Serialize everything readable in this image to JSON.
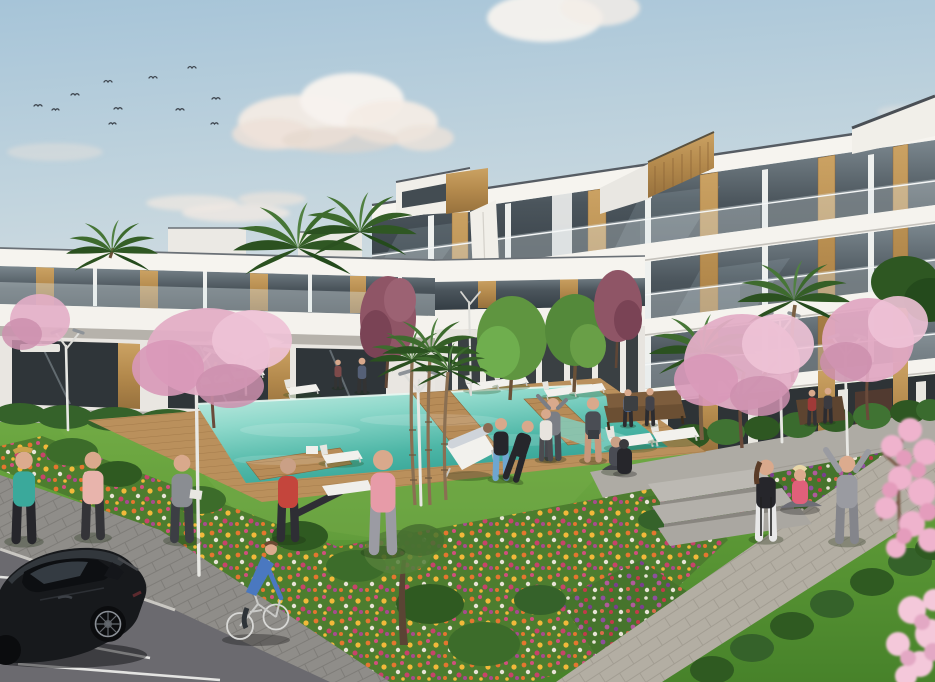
{
  "scene": {
    "description": "Architectural render of a modern white apartment complex with communal pool, lawns, flower beds, palm and cherry-blossom trees, people exercising, a cyclist and a parked black car",
    "sky": {
      "top_color": "#a6c4d8",
      "horizon_color": "#dde2e4",
      "cloud_color": "#f6f2ec",
      "bird_count": 11,
      "bird_color": "#3f4750"
    },
    "buildings": {
      "right_block": {
        "floors": 3,
        "style": "white slab balconies, dark glass, timber piers",
        "wall_color": "#f3f1ec",
        "glass_color": "#39424a",
        "wood_color": "#c09454",
        "roof_edge_color": "#565c63",
        "penthouse_count": 3
      },
      "left_row": {
        "floors": 2,
        "wall_color": "#eceae5",
        "glass_color": "#2f3539",
        "wood_color": "#b98c4e"
      }
    },
    "pool": {
      "water_light": "#cdeee6",
      "water_deep": "#2f9f92",
      "deck_wood": "#b78c58",
      "shape": "rectangular with timber walkway crossings",
      "lounger_count": 9,
      "umbrella_color": "#f4f1ea"
    },
    "landscape": {
      "grass_light": "#76b04a",
      "grass_dark": "#4e8a2d",
      "hedge_color": "#35622a",
      "flower_colors": [
        "#e5762f",
        "#d14f7d",
        "#f2b93a",
        "#8e4f9e",
        "#c23a4a",
        "#e8e3d6"
      ],
      "palm_count": 8,
      "blossom_tree_color": "#e3aec6",
      "maroon_tree_color": "#8f5566",
      "lamp_count": 6,
      "lamp_color": "#e8e8e4",
      "bench_count": 3
    },
    "paths": {
      "left_path_color": "#8f8d89",
      "right_path_color": "#b3aea3",
      "parking_color": "#6b6a6f",
      "stall_line_color": "#e4e4e2",
      "step_count": 3
    },
    "vehicles": {
      "car": {
        "type": "black hatchback",
        "body_color": "#17191c",
        "position": "bottom-left parking",
        "wheel_rim_color": "#8a8f96"
      },
      "bicycle": {
        "frame_color": "#d8d8d6",
        "rider_top_color": "#4a78c0",
        "rider_pants_color": "#2e3338"
      }
    },
    "people": [
      {
        "id": "jogger-woman",
        "top": "#3aa99b",
        "bottom": "#26262b",
        "activity": "jogging",
        "area": "left path"
      },
      {
        "id": "jogger-man",
        "top": "#e8b4ac",
        "bottom": "#343438",
        "activity": "jogging",
        "area": "left path"
      },
      {
        "id": "stander-gray",
        "top": "#8a8d92",
        "bottom": "#3c3e44",
        "activity": "standing",
        "area": "lawn left"
      },
      {
        "id": "stretcher-red",
        "top": "#c4453c",
        "bottom": "#2e2e34",
        "activity": "stretching on lounger",
        "area": "lawn left"
      },
      {
        "id": "walker-pink",
        "top": "#e79ba8",
        "bottom": "#9b9ba3",
        "activity": "walking",
        "area": "lawn left"
      },
      {
        "id": "deckchair-person",
        "top": "#cfd4da",
        "activity": "reclining",
        "area": "lawn centre"
      },
      {
        "id": "exerciser-leggings",
        "top": "#26262b",
        "bottom": "#6fa6cf",
        "activity": "exercising",
        "area": "lawn centre"
      },
      {
        "id": "exerciser-black",
        "top": "#26262b",
        "bottom": "#26262b",
        "activity": "bending",
        "area": "lawn centre"
      },
      {
        "id": "exerciser-hoodie",
        "top": "#7b7e85",
        "activity": "arm raised",
        "area": "lawn centre"
      },
      {
        "id": "exerciser-shorts",
        "top": "#4a4d54",
        "activity": "stretching",
        "area": "lawn centre"
      },
      {
        "id": "yoga-seated",
        "top": "#3f4148",
        "activity": "seated yoga",
        "area": "lawn centre"
      },
      {
        "id": "stander-leggings",
        "top": "#26262b",
        "bottom": "#e8e8e8",
        "activity": "standing",
        "area": "right path"
      },
      {
        "id": "sitter-pink",
        "top": "#e0607a",
        "activity": "sitting",
        "area": "right path"
      },
      {
        "id": "arms-raised-gray",
        "top": "#9a9ba1",
        "activity": "arms raised",
        "area": "right path"
      },
      {
        "id": "bench-couple",
        "area": "centre bench"
      },
      {
        "id": "bench-sitter-red",
        "top": "#a03a38",
        "area": "right bench"
      },
      {
        "id": "background-walkers",
        "count": 3,
        "area": "building walkway"
      },
      {
        "id": "cyclist",
        "area": "left path"
      }
    ]
  }
}
